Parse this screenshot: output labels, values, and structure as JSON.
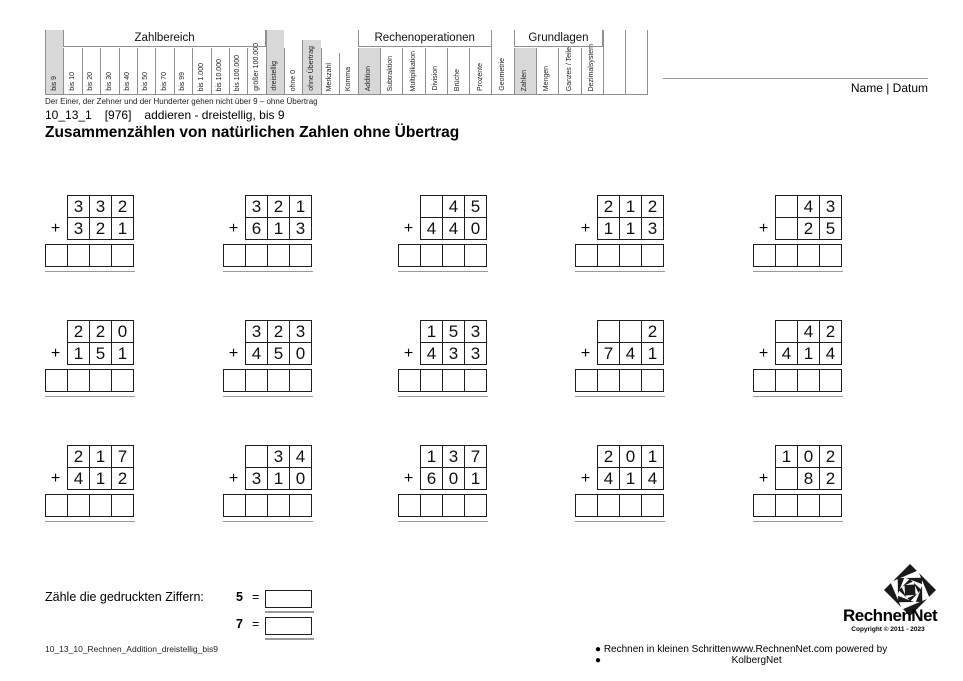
{
  "colors": {
    "highlight": "#d8d8d8",
    "table_border": "#8f8f8f",
    "grid_border": "#1e1e1e",
    "double_underline": "#9a9a9a"
  },
  "header": {
    "groups": [
      {
        "label": "Zahlbereich",
        "start": 1,
        "span": 11
      },
      {
        "label": "Rechenoperationen",
        "start": 17,
        "span": 6
      },
      {
        "label": "Grundlagen",
        "start": 24,
        "span": 4
      }
    ],
    "columns": [
      {
        "label": "bis 9",
        "selected": true,
        "size": "full"
      },
      {
        "label": "bis 10",
        "size": "mid"
      },
      {
        "label": "bis 20",
        "size": "mid"
      },
      {
        "label": "bis 30",
        "size": "mid"
      },
      {
        "label": "bis 40",
        "size": "mid"
      },
      {
        "label": "bis 50",
        "size": "mid"
      },
      {
        "label": "bis 70",
        "size": "mid"
      },
      {
        "label": "bis 99",
        "size": "mid"
      },
      {
        "label": "bis 1.000",
        "size": "mid"
      },
      {
        "label": "bis 10.000",
        "size": "mid"
      },
      {
        "label": "bis 100.000",
        "size": "mid"
      },
      {
        "label": "größer 100.000",
        "size": "mid"
      },
      {
        "label": "dreistellig",
        "selected": true,
        "size": "full"
      },
      {
        "label": "ohne 0",
        "size": "mid"
      },
      {
        "label": "ohne Übertrag",
        "selected": true,
        "size": "tall"
      },
      {
        "label": "Merkzahl",
        "size": "mid"
      },
      {
        "label": "Komma",
        "size": "short"
      },
      {
        "label": "Addition",
        "selected": true,
        "size": "mid"
      },
      {
        "label": "Subtraktion",
        "size": "mid"
      },
      {
        "label": "Multiplikation",
        "size": "mid"
      },
      {
        "label": "Division",
        "size": "mid"
      },
      {
        "label": "Brüche",
        "size": "mid"
      },
      {
        "label": "Prozente",
        "size": "mid"
      },
      {
        "label": "Geometrie",
        "size": "full"
      },
      {
        "label": "Zahlen",
        "selected": true,
        "size": "mid"
      },
      {
        "label": "Mengen",
        "size": "mid"
      },
      {
        "label": "Ganzes / Teile",
        "size": "mid"
      },
      {
        "label": "Dezimalsystem",
        "size": "mid"
      },
      {
        "label": "",
        "size": "full"
      },
      {
        "label": "",
        "size": "full"
      }
    ],
    "name_datum": "Name | Datum"
  },
  "meta": {
    "note": "Der Einer, der Zehner und der Hunderter gehen nicht über 9 – ohne Übertrag",
    "code": "10_13_1",
    "ref": "[976]",
    "subtitle": "addieren - dreistellig, bis 9",
    "title": "Zusammenzählen von natürlichen Zahlen ohne Übertrag"
  },
  "problems": {
    "plus_sign": "+",
    "items": [
      {
        "top": [
          "3",
          "3",
          "2"
        ],
        "bottom": [
          "3",
          "2",
          "1"
        ]
      },
      {
        "top": [
          "3",
          "2",
          "1"
        ],
        "bottom": [
          "6",
          "1",
          "3"
        ]
      },
      {
        "top": [
          "",
          "4",
          "5"
        ],
        "bottom": [
          "4",
          "4",
          "0"
        ]
      },
      {
        "top": [
          "2",
          "1",
          "2"
        ],
        "bottom": [
          "1",
          "1",
          "3"
        ]
      },
      {
        "top": [
          "",
          "4",
          "3"
        ],
        "bottom": [
          "",
          "2",
          "5"
        ]
      },
      {
        "top": [
          "2",
          "2",
          "0"
        ],
        "bottom": [
          "1",
          "5",
          "1"
        ]
      },
      {
        "top": [
          "3",
          "2",
          "3"
        ],
        "bottom": [
          "4",
          "5",
          "0"
        ]
      },
      {
        "top": [
          "1",
          "5",
          "3"
        ],
        "bottom": [
          "4",
          "3",
          "3"
        ]
      },
      {
        "top": [
          "",
          "",
          "2"
        ],
        "bottom": [
          "7",
          "4",
          "1"
        ]
      },
      {
        "top": [
          "",
          "4",
          "2"
        ],
        "bottom": [
          "4",
          "1",
          "4"
        ]
      },
      {
        "top": [
          "2",
          "1",
          "7"
        ],
        "bottom": [
          "4",
          "1",
          "2"
        ]
      },
      {
        "top": [
          "",
          "3",
          "4"
        ],
        "bottom": [
          "3",
          "1",
          "0"
        ]
      },
      {
        "top": [
          "1",
          "3",
          "7"
        ],
        "bottom": [
          "6",
          "0",
          "1"
        ]
      },
      {
        "top": [
          "2",
          "0",
          "1"
        ],
        "bottom": [
          "4",
          "1",
          "4"
        ]
      },
      {
        "top": [
          "1",
          "0",
          "2"
        ],
        "bottom": [
          "",
          "8",
          "2"
        ]
      }
    ]
  },
  "count_task": {
    "label": "Zähle die gedruckten Ziffern:",
    "items": [
      {
        "digit": "5",
        "equals": "="
      },
      {
        "digit": "7",
        "equals": "="
      }
    ]
  },
  "footer": {
    "left": "10_13_10_Rechnen_Addition_dreistellig_bis9",
    "center": "● Rechnen in kleinen Schritten ●",
    "right": "www.RechnenNet.com powered by KolbergNet",
    "logo_text": "RechnenNet",
    "copyright": "Copyright © 2011 - 2023"
  }
}
